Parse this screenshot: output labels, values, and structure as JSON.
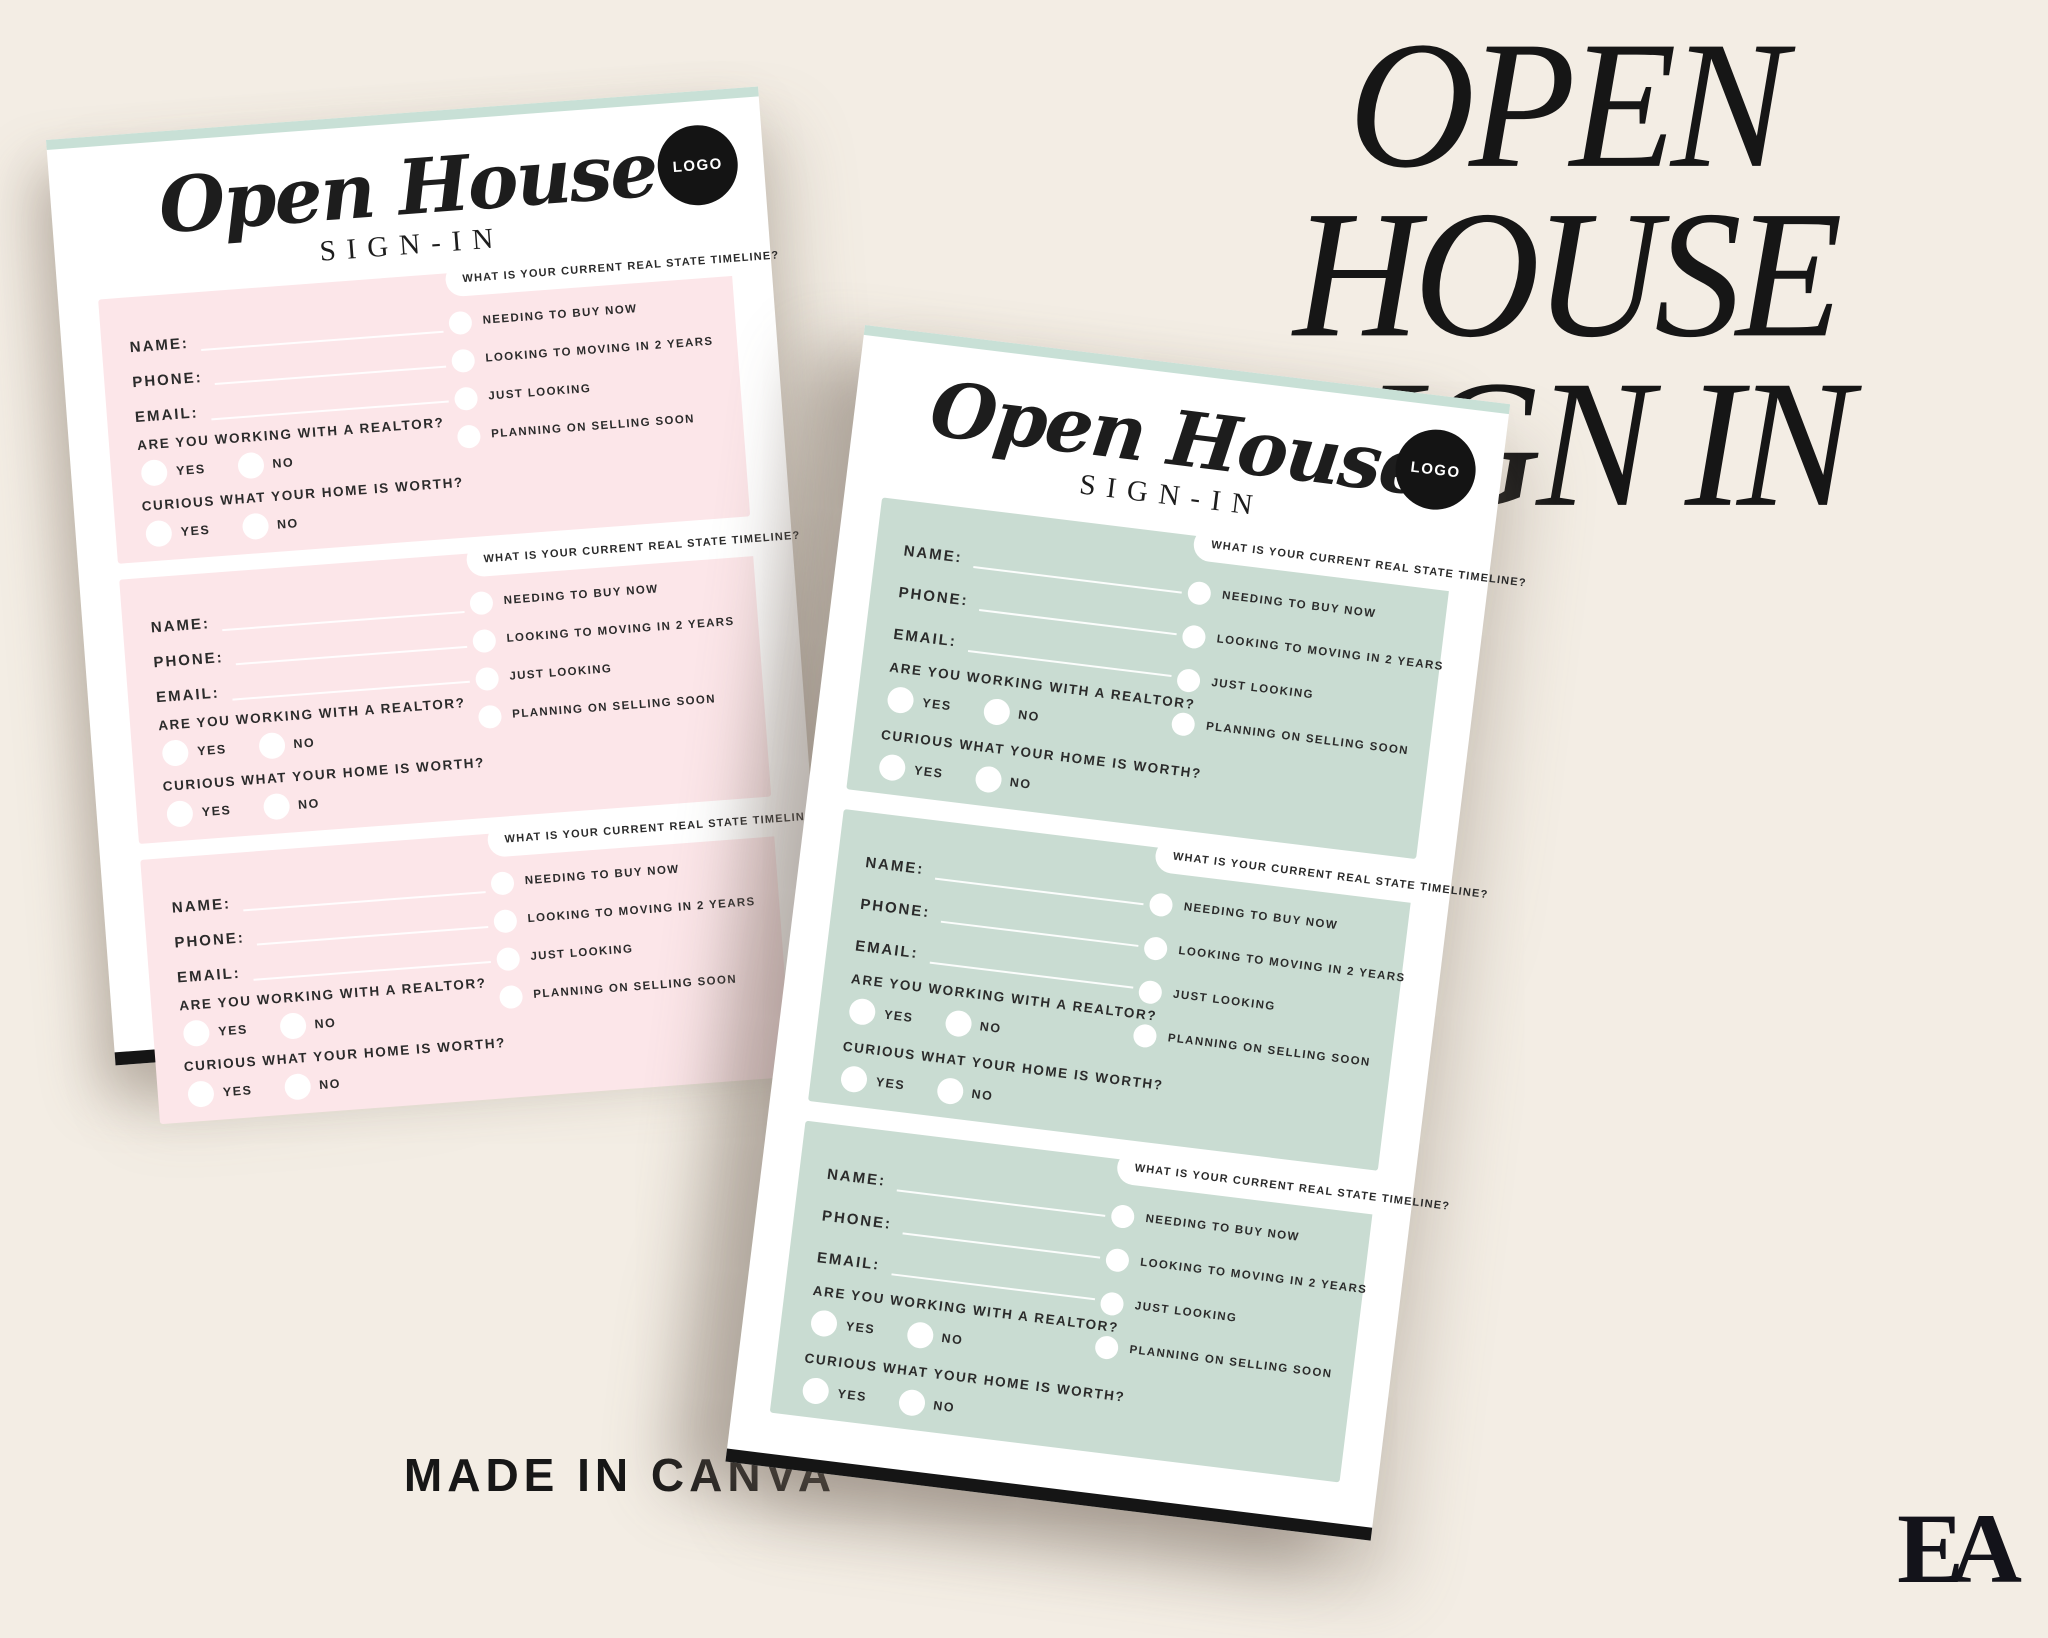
{
  "page": {
    "background": "#f3ede4"
  },
  "headline": {
    "line1": "OPEN HOUSE",
    "line2": "SIGN IN"
  },
  "footer": {
    "made_in": "MADE IN CANVA",
    "brand_logo": "EA"
  },
  "sheet": {
    "script_title": "Open House",
    "subtitle": "SIGN-IN",
    "logo_label": "LOGO",
    "entries_per_page": 3,
    "fields": [
      "NAME:",
      "PHONE:",
      "EMAIL:"
    ],
    "questions": [
      {
        "text": "ARE YOU WORKING  WITH A REALTOR?",
        "options": [
          "YES",
          "NO"
        ]
      },
      {
        "text": "CURIOUS WHAT YOUR HOME IS WORTH?",
        "options": [
          "YES",
          "NO"
        ]
      }
    ],
    "timeline": {
      "header": "WHAT IS YOUR CURRENT REAL STATE TIMELINE?",
      "options": [
        "NEEDING TO BUY NOW",
        "LOOKING TO MOVING IN 2 YEARS",
        "JUST LOOKING",
        "PLANNING ON SELLING SOON"
      ]
    }
  },
  "variants": {
    "pink_section_color": "#fce6e9",
    "mint_section_color": "#c9dcd2",
    "paper_edge_color": "#c8e0d6",
    "background_color": "#f3ede4"
  }
}
